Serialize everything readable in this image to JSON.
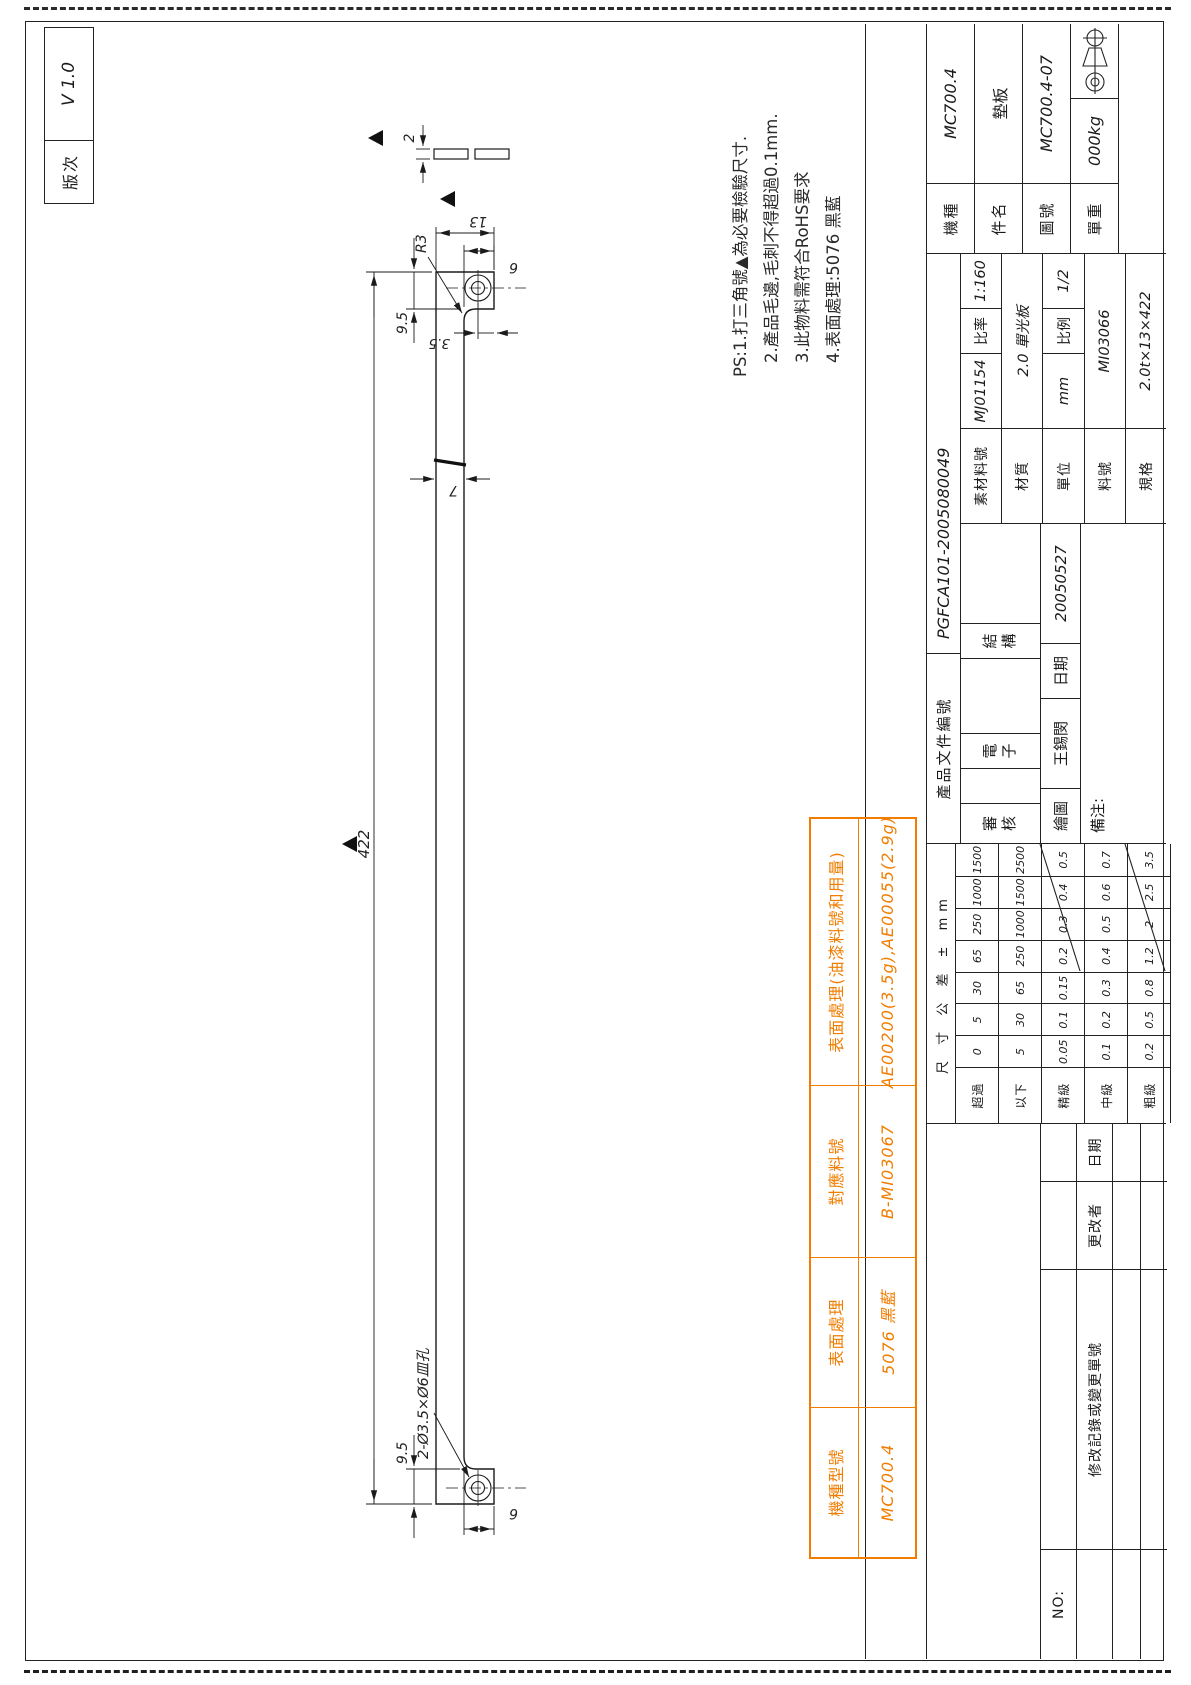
{
  "version_box": {
    "label": "版次",
    "value": "V 1.0"
  },
  "notes": {
    "line1": "PS:1.打三角號▲為必要檢驗尺寸.",
    "line2": "2.產品毛邊,毛刺不得超過0.1mm.",
    "line3": "3.此物料需符合RoHS要求",
    "line4": "4.表面處理:5076 黑藍"
  },
  "orange_table": {
    "accent_color": "#f07d00",
    "headers": [
      "機種型號",
      "表面處理",
      "對應料號",
      "表面處理(油漆料號和用量)"
    ],
    "values": [
      "MC700.4",
      "5076 黑藍",
      "B-MI03067",
      "AE00200(3.5g),AE00055(2.9g)"
    ]
  },
  "drawing": {
    "dim_length": "422",
    "dim_width": "13",
    "dim_end_length_right": "9.5",
    "dim_end_length_left": "9.5",
    "dim_end_width_right": "6",
    "dim_end_width_left": "6",
    "dim_hole_offset": "3.5",
    "dim_mid_width": "7",
    "dim_thickness": "2",
    "radius_callout": "R3",
    "hole_callout": "2-Ø3.5×Ø6皿孔"
  },
  "title_block": {
    "product_doc_label": "產品文件編號",
    "product_doc_value": "PGFCA101-2005080049",
    "review_label": "審核",
    "electronic_label": "電子",
    "structure_label": "結構",
    "draw_label": "繪圖",
    "drafter": "王錫閔",
    "date_label": "日期",
    "date_value": "20050527",
    "remarks_label": "備注:",
    "material_rows": [
      {
        "label": "素材料號",
        "value": "MJ01154",
        "label2": "比率",
        "value2": "1:160"
      },
      {
        "label": "材質",
        "value": "2.0 單光板"
      },
      {
        "label": "單位",
        "value": "mm",
        "label2": "比例",
        "value2": "1/2"
      },
      {
        "label": "料號",
        "value": "MI03066"
      },
      {
        "label": "規格",
        "value": "2.0t×13×422"
      }
    ],
    "part_rows": [
      {
        "label": "機種",
        "value": "MC700.4"
      },
      {
        "label": "件名",
        "value": "墊板"
      },
      {
        "label": "圖號",
        "value": "MC700.4-07"
      },
      {
        "label": "單重",
        "value": "000kg"
      }
    ],
    "revision": {
      "no_label": "NO:",
      "headers": [
        "修改記錄或變更單號",
        "更改者",
        "日期"
      ]
    }
  },
  "tolerance_table": {
    "title": "尺 寸 公 差 ± mm",
    "rows": [
      {
        "label": "超過",
        "values": [
          "0",
          "5",
          "30",
          "65",
          "250",
          "1000",
          "1500"
        ]
      },
      {
        "label": "以下",
        "values": [
          "5",
          "30",
          "65",
          "250",
          "1000",
          "1500",
          "2500"
        ]
      },
      {
        "label": "精級",
        "values": [
          "0.05",
          "0.1",
          "0.15",
          "0.2",
          "0.3",
          "0.4",
          "0.5"
        ]
      },
      {
        "label": "中級",
        "values": [
          "0.1",
          "0.2",
          "0.3",
          "0.4",
          "0.5",
          "0.6",
          "0.7"
        ]
      },
      {
        "label": "粗級",
        "values": [
          "0.2",
          "0.5",
          "0.8",
          "1.2",
          "2",
          "2.5",
          "3.5"
        ]
      }
    ]
  }
}
